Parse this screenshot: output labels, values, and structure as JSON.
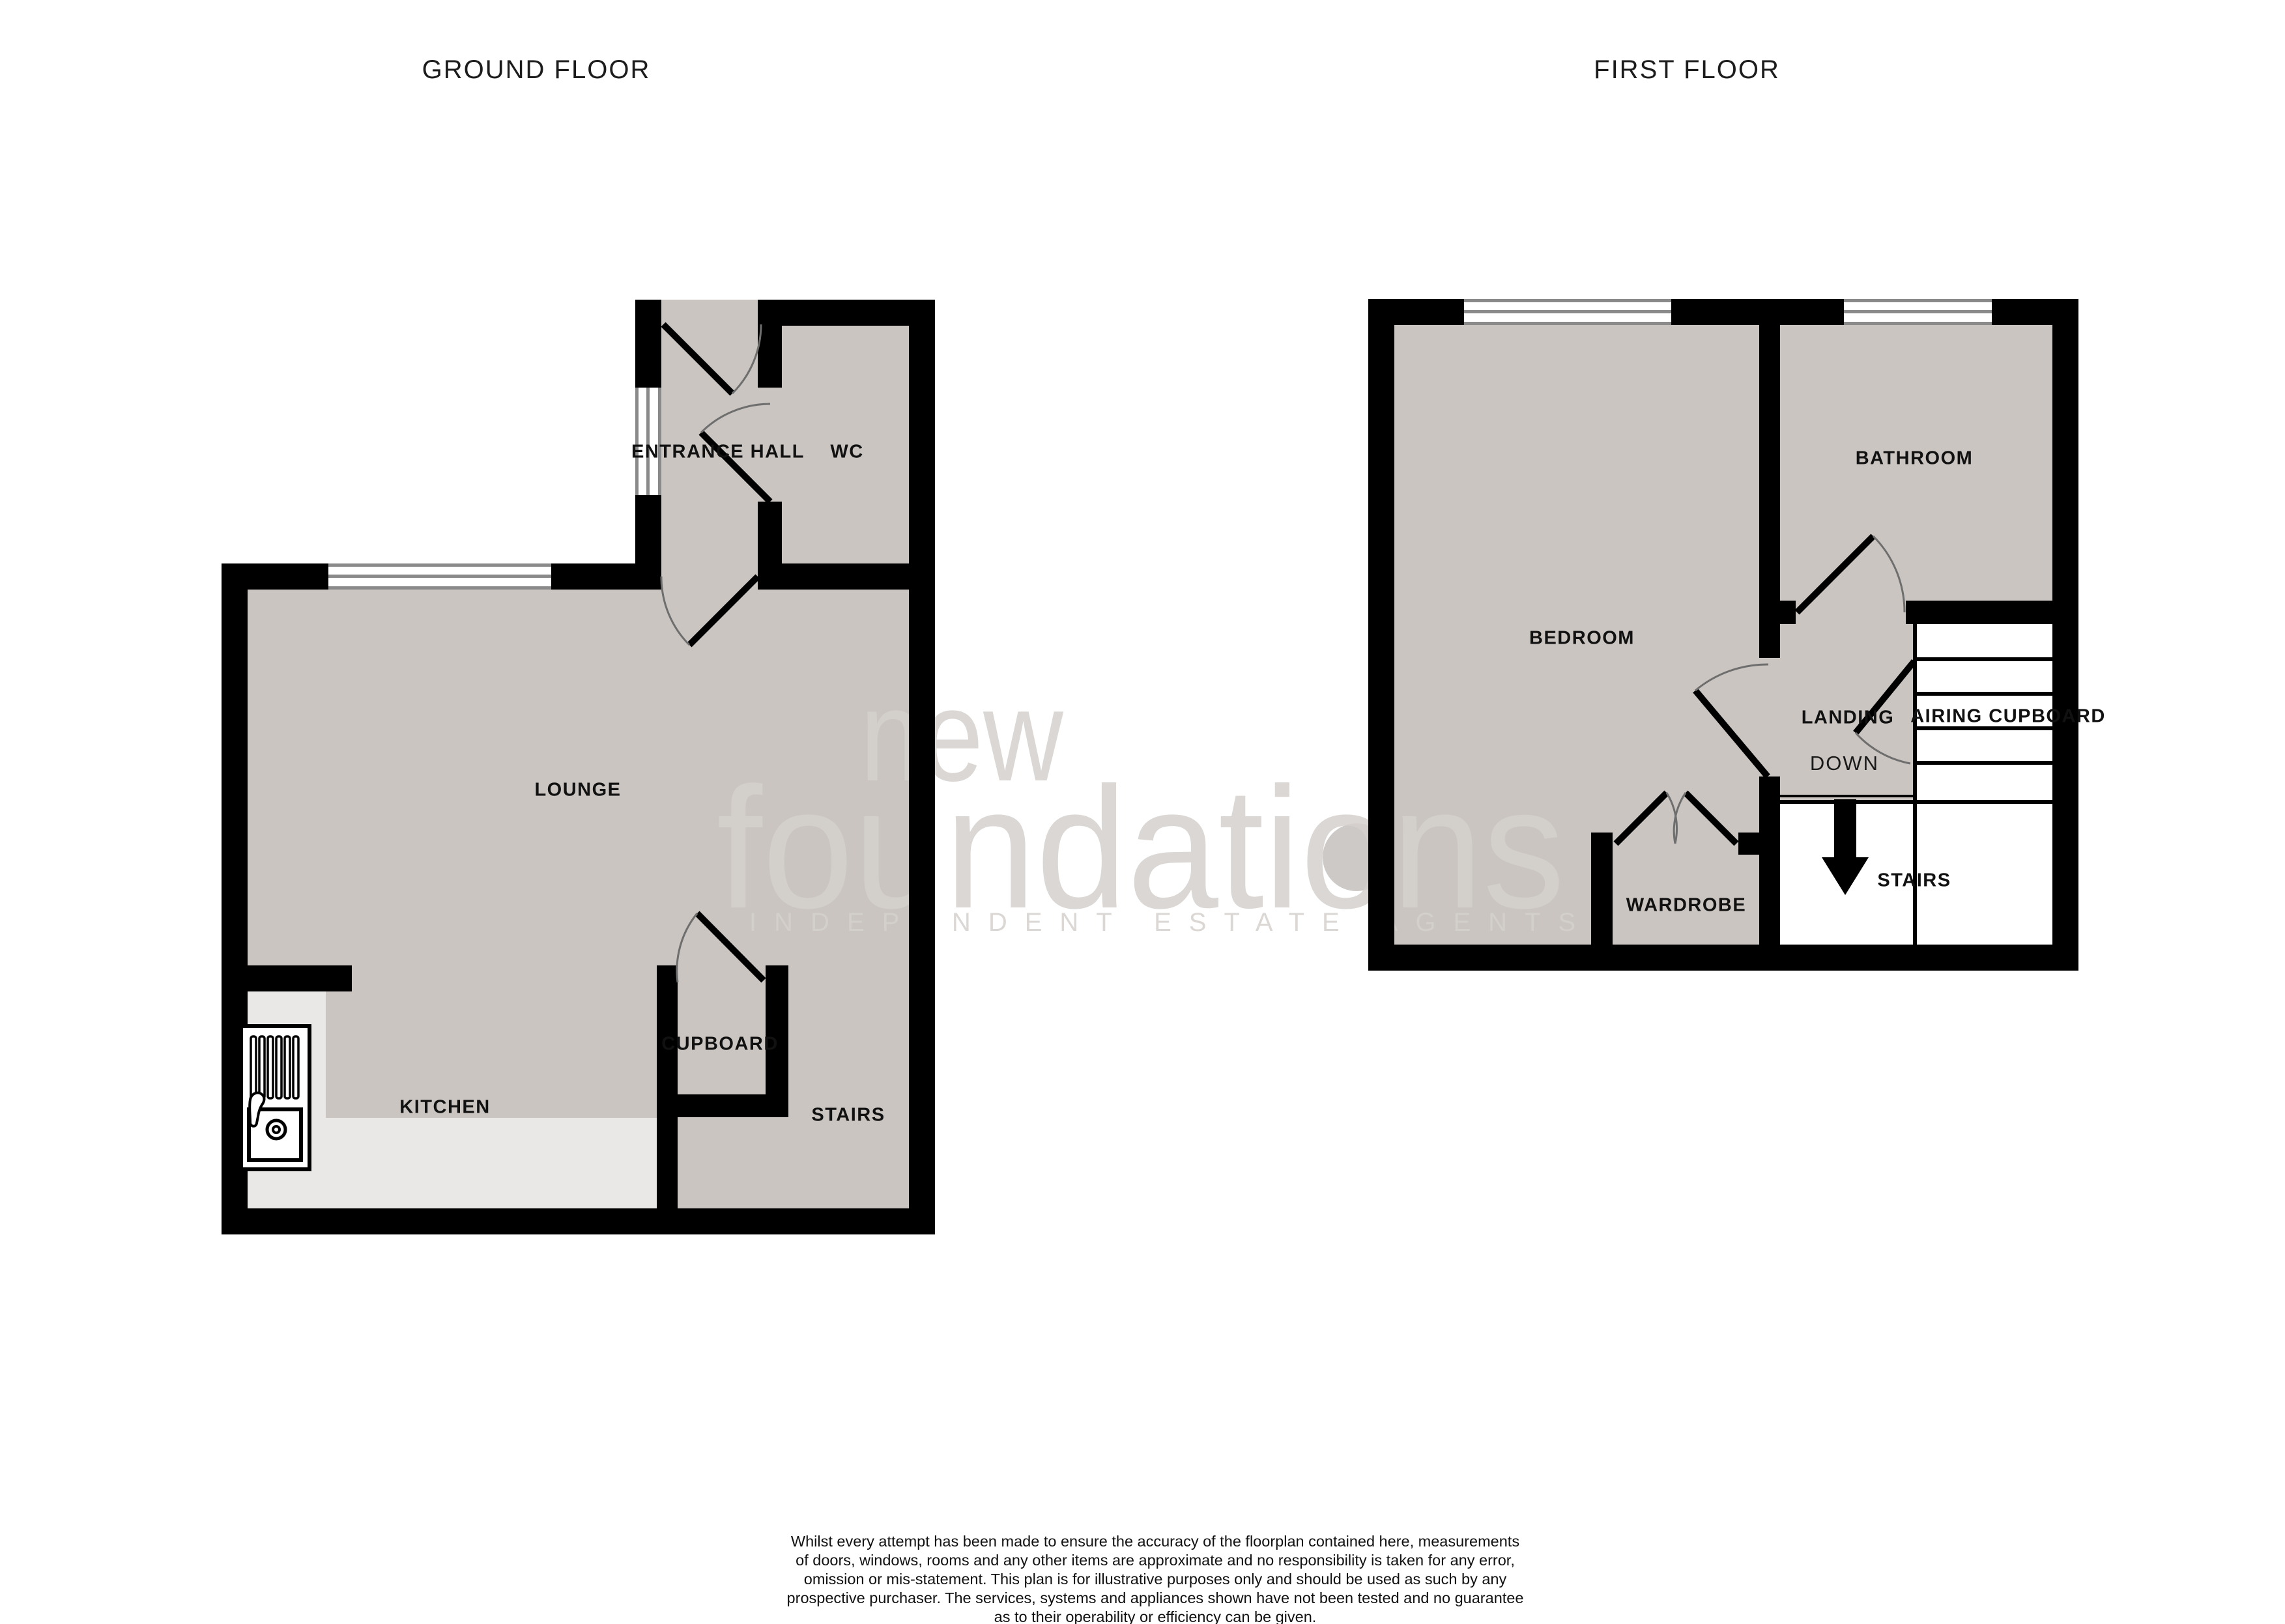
{
  "page": {
    "background": "#ffffff",
    "floor_color": "#cac5c1",
    "kitchen_floor_color": "#e9e8e6",
    "wall_color": "#000000",
    "window_frame_color": "#8a8a8a"
  },
  "ground_floor": {
    "title": "GROUND FLOOR",
    "rooms": {
      "entrance_hall": "ENTRANCE HALL",
      "wc": "WC",
      "lounge": "LOUNGE",
      "kitchen": "KITCHEN",
      "cupboard": "CUPBOARD",
      "stairs": "STAIRS"
    }
  },
  "first_floor": {
    "title": "FIRST FLOOR",
    "rooms": {
      "bedroom": "BEDROOM",
      "bathroom": "BATHROOM",
      "landing": "LANDING",
      "airing_cupboard": "AIRING CUPBOARD",
      "down": "DOWN",
      "stairs": "STAIRS",
      "wardrobe": "WARDROBE"
    }
  },
  "icons": {
    "sink": "kitchen-sink-icon",
    "down_arrow": "stairs-down-arrow-icon"
  },
  "watermark": {
    "line1": "new",
    "line2": "foundations",
    "line3": "INDEPENDENT ESTATE AGENTS"
  },
  "footer": {
    "lines": [
      "Whilst every attempt has been made to ensure the accuracy of the floorplan contained here, measurements",
      "of doors, windows, rooms and any other items are approximate and no responsibility is taken for any error,",
      "omission or mis-statement. This plan is for illustrative purposes only and should be used as such by any",
      "prospective purchaser. The services, systems and appliances shown have not been tested and no guarantee",
      "as to their operability or efficiency can be given.",
      "Made with Metropix ©2025"
    ]
  }
}
